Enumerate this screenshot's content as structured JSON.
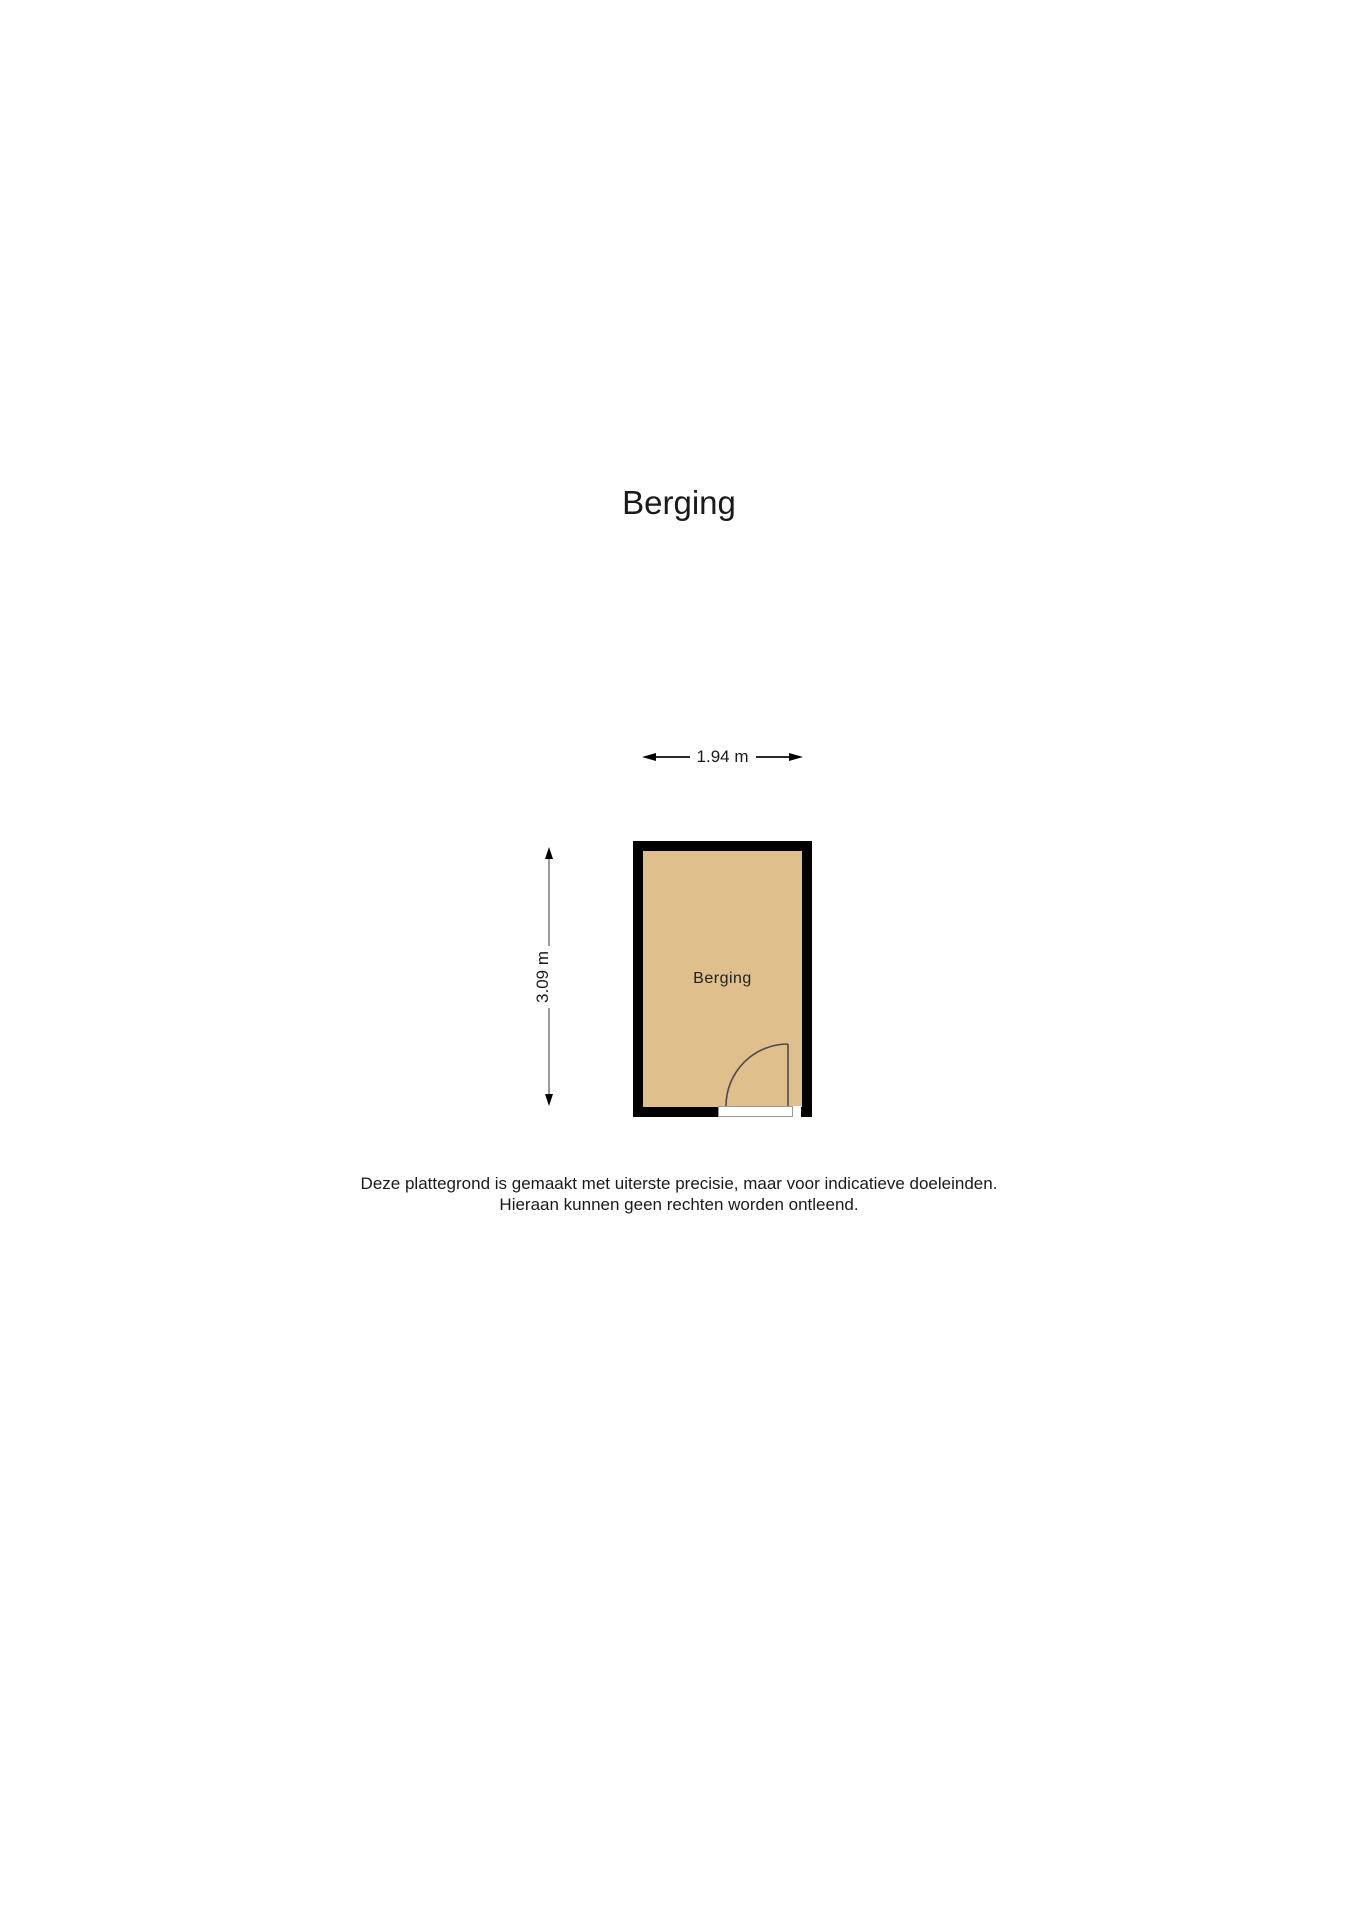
{
  "page_title": "Berging",
  "plan": {
    "room_label": "Berging",
    "width_dimension": "1.94 m",
    "height_dimension": "3.09 m",
    "colors": {
      "room_fill": "#dfc08d",
      "wall": "#000000",
      "vertical_dimension_line": "#9a9a9a",
      "horizontal_dimension_line": "#2b2b2b",
      "door_line": "#4a4a4a",
      "threshold_line": "#999999"
    }
  },
  "disclaimer": {
    "line1": "Deze plattegrond is gemaakt met uiterste precisie, maar voor indicatieve doeleinden.",
    "line2": "Hieraan kunnen geen rechten worden ontleend."
  }
}
